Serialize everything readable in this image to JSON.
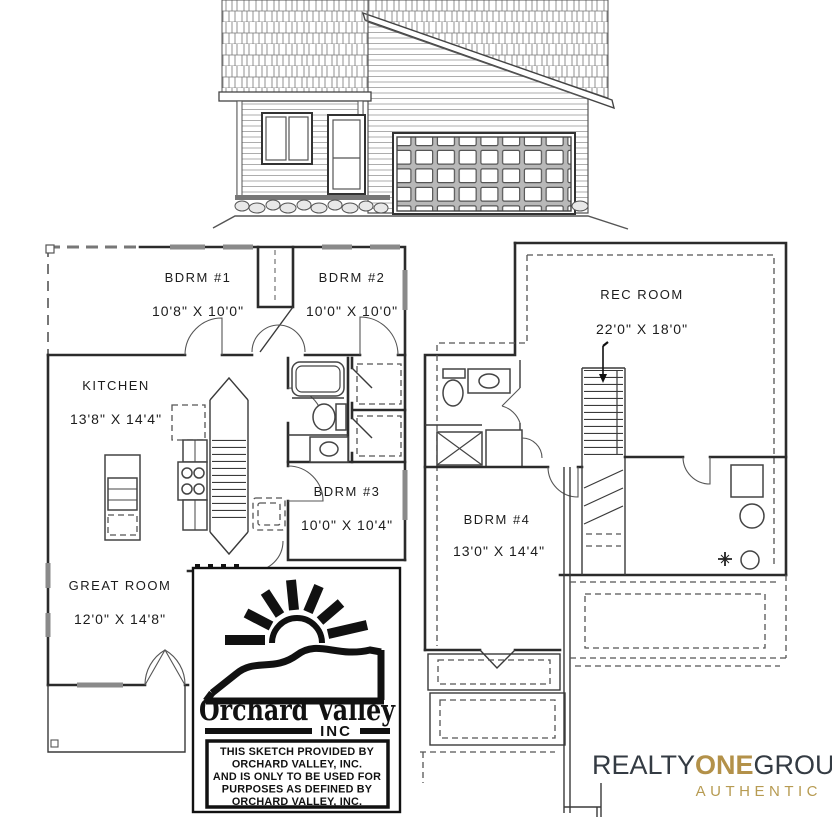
{
  "floor_plans": {
    "main": {
      "rooms": [
        {
          "label": "BDRM #1",
          "dims": "10'8\" X 10'0\""
        },
        {
          "label": "BDRM #2",
          "dims": "10'0\" X 10'0\""
        },
        {
          "label": "KITCHEN",
          "dims": "13'8\" X 14'4\""
        },
        {
          "label": "BDRM #3",
          "dims": "10'0\" X 10'4\""
        },
        {
          "label": "GREAT ROOM",
          "dims": "12'0\" X 14'8\""
        }
      ]
    },
    "basement": {
      "rooms": [
        {
          "label": "REC ROOM",
          "dims": "22'0\" X 18'0\""
        },
        {
          "label": "BDRM #4",
          "dims": "13'0\" X 14'4\""
        }
      ]
    }
  },
  "builder": {
    "name": "Orchard Valley",
    "suffix": "INC",
    "disclaimer_lines": [
      "THIS SKETCH PROVIDED BY",
      "ORCHARD VALLEY, INC.",
      "AND IS ONLY TO BE USED FOR",
      "PURPOSES AS DEFINED BY",
      "ORCHARD VALLEY, INC."
    ]
  },
  "brokerage": {
    "name_part1": "REALTY",
    "name_part2": "ONE",
    "name_part3": "GROUP",
    "tagline": "AUTHENTIC",
    "colors": {
      "dark": "#343b43",
      "gold": "#b39149"
    }
  }
}
